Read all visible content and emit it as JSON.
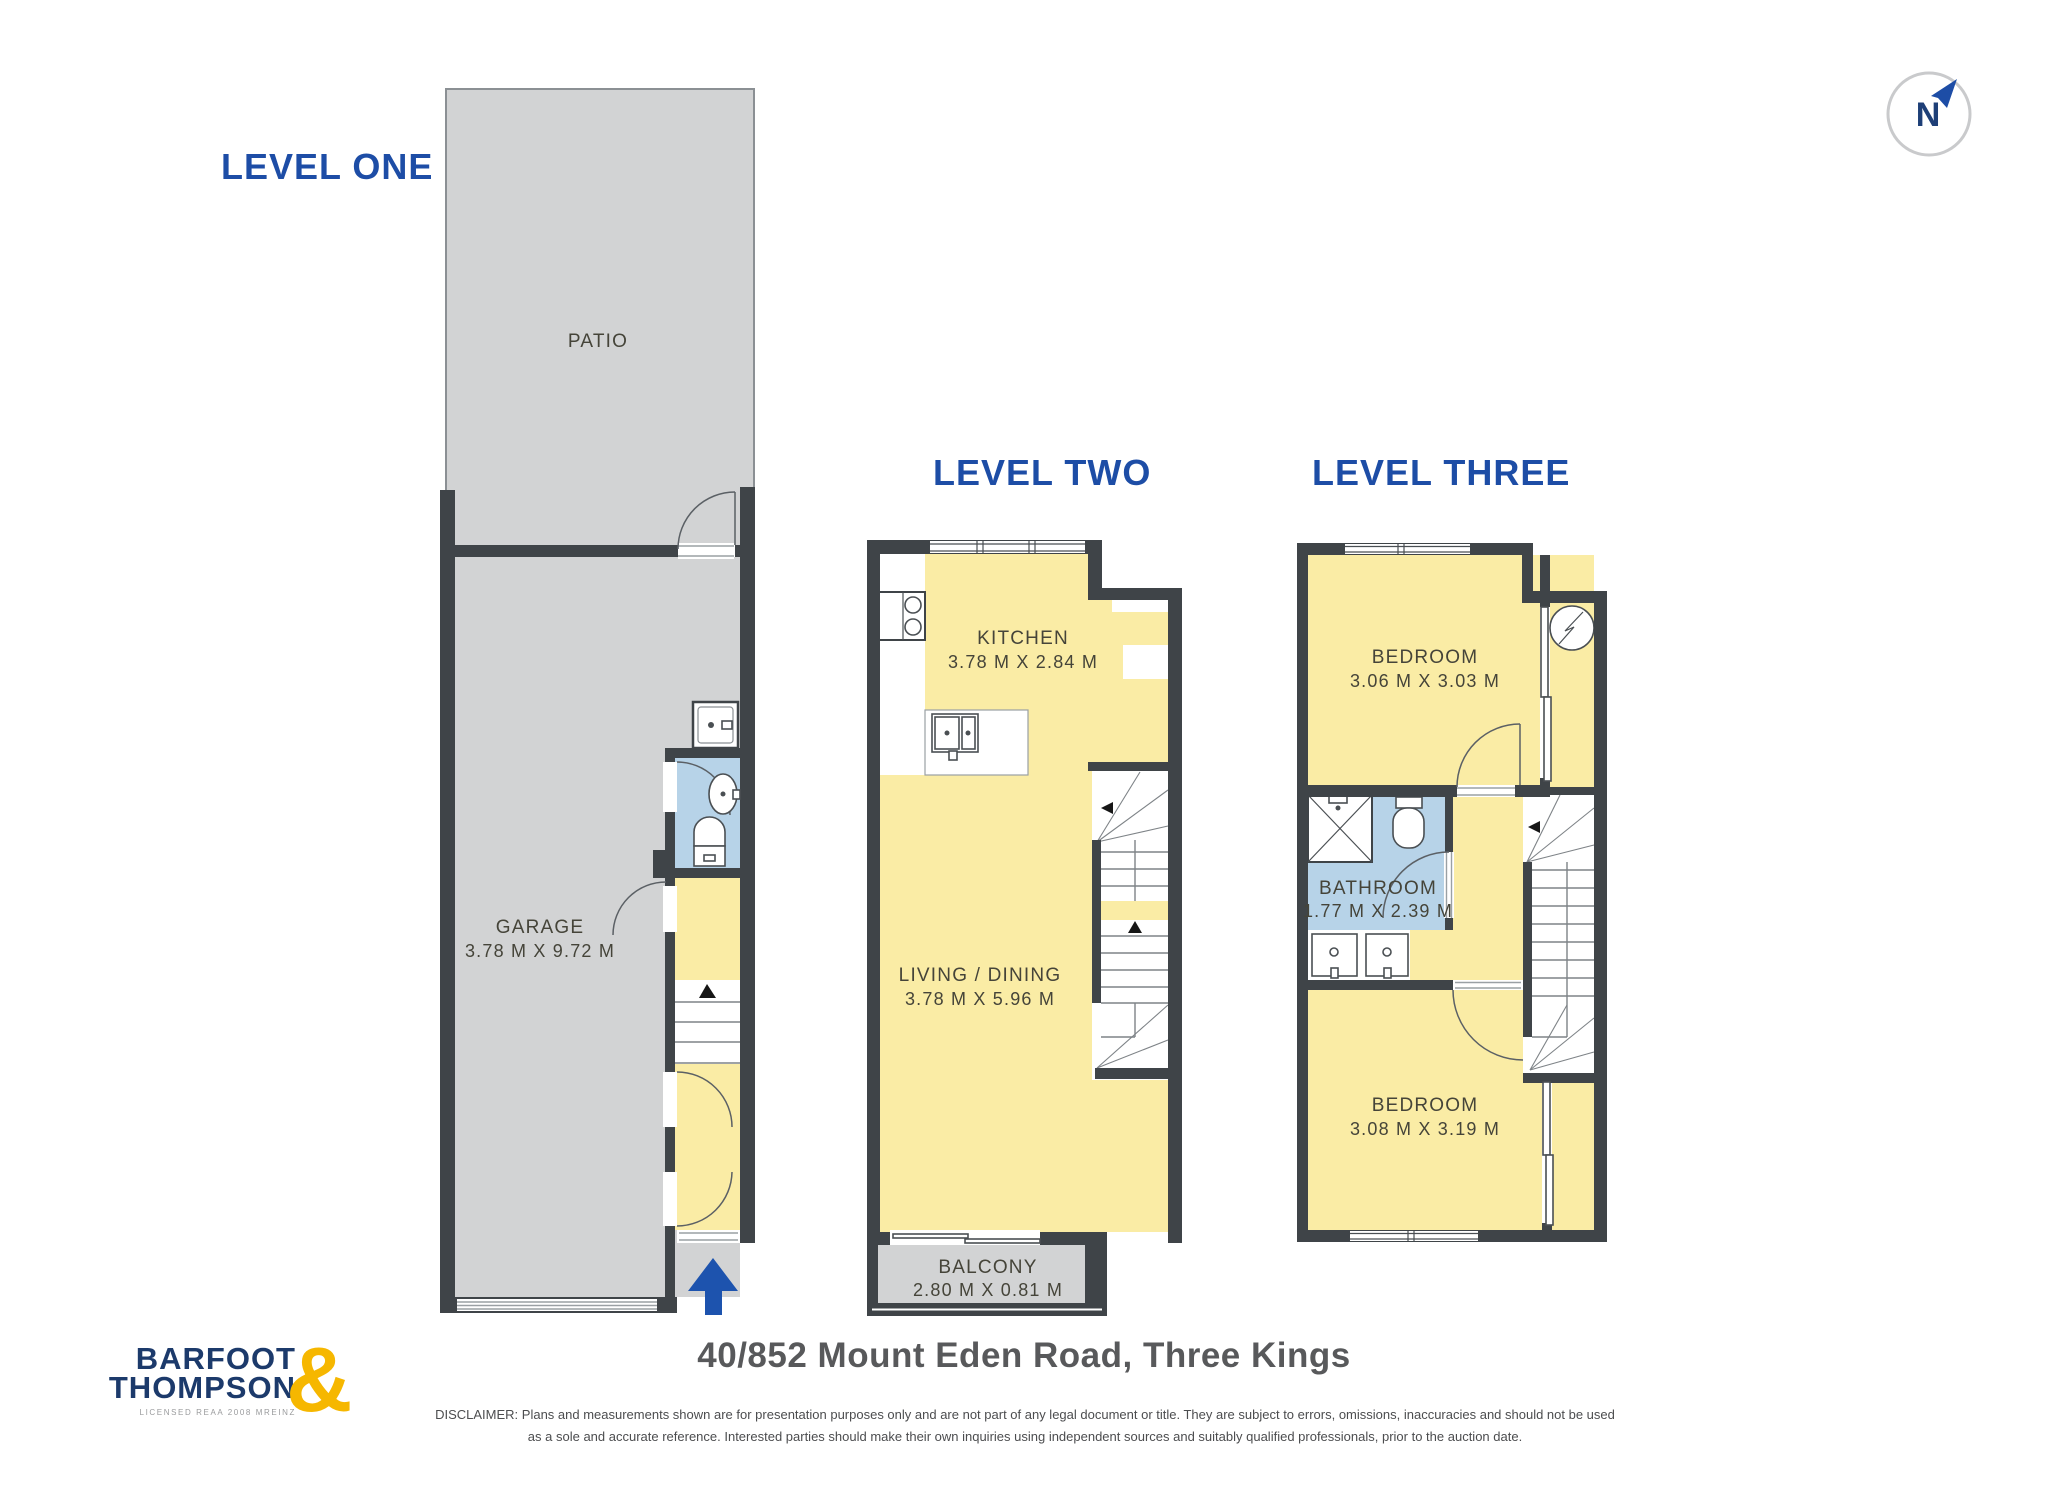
{
  "page": {
    "address": "40/852 Mount Eden Road, Three Kings",
    "disclaimer_line1": "DISCLAIMER: Plans and measurements shown are for presentation purposes only and are not part of any legal document or title. They are subject to errors, omissions, inaccuracies and should not be used",
    "disclaimer_line2": "as a sole and accurate reference. Interested parties should make their own inquiries using independent sources and suitably qualified professionals, prior to the auction date."
  },
  "compass": {
    "label": "N"
  },
  "logo": {
    "word1": "BARFOOT",
    "word2": "THOMPSON",
    "ampersand": "&",
    "tagline": "LICENSED REAA 2008 MREINZ"
  },
  "colors": {
    "title_blue": "#1D4DA6",
    "wall_dark": "#3F4448",
    "room_yellow": "#FAECA5",
    "outdoor_gray": "#D2D3D4",
    "bathroom_blue": "#B7D3E8",
    "entry_arrow_blue": "#1D53AE",
    "logo_navy": "#1C3A6B",
    "logo_gold": "#F6B700",
    "room_label_text": "#454439",
    "address_text": "#58595B"
  },
  "levels": {
    "one": {
      "title": "LEVEL ONE",
      "rooms": {
        "patio": {
          "name": "PATIO"
        },
        "garage": {
          "name": "GARAGE",
          "dims": "3.78 M X 9.72 M"
        }
      }
    },
    "two": {
      "title": "LEVEL TWO",
      "rooms": {
        "kitchen": {
          "name": "KITCHEN",
          "dims": "3.78 M X 2.84 M"
        },
        "living": {
          "name": "LIVING / DINING",
          "dims": "3.78 M X 5.96 M"
        },
        "balcony": {
          "name": "BALCONY",
          "dims": "2.80 M X 0.81 M"
        }
      }
    },
    "three": {
      "title": "LEVEL THREE",
      "rooms": {
        "bedroom_top": {
          "name": "BEDROOM",
          "dims": "3.06 M X 3.03 M"
        },
        "bathroom": {
          "name": "BATHROOM",
          "dims": "1.77 M X 2.39 M"
        },
        "bedroom_bottom": {
          "name": "BEDROOM",
          "dims": "3.08 M X 3.19 M"
        }
      }
    }
  }
}
